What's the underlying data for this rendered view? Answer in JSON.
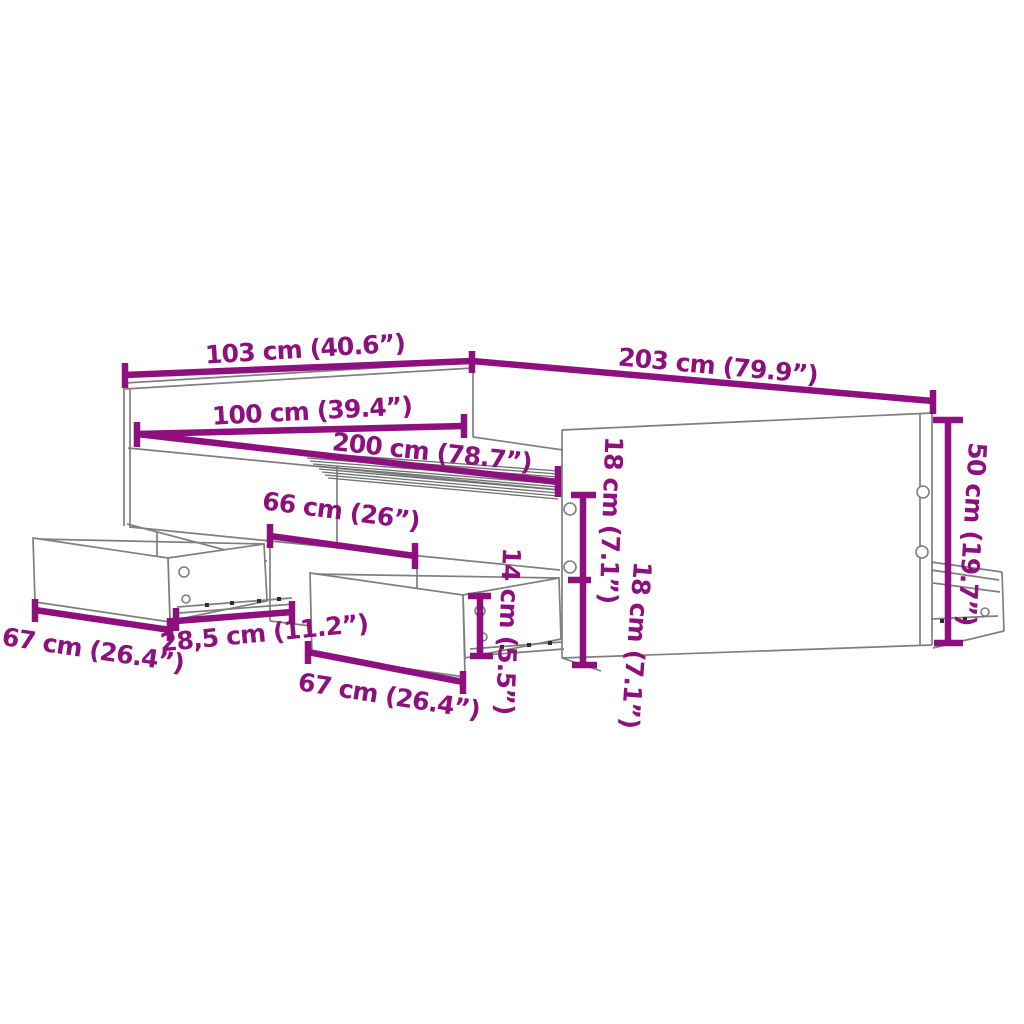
{
  "colors": {
    "dimension": "#8E0F7E",
    "line": "#7f7f7f",
    "slat": "#6f6f6f",
    "background": "#ffffff"
  },
  "labels": {
    "outer_width": "103 cm (40.6”)",
    "outer_length": "203 cm (79.9”)",
    "inner_width": "100 cm (39.4”)",
    "inner_length": "200 cm (78.7”)",
    "drawer_opening_width": "66 cm (26”)",
    "side_panel_height": "50 cm (19.7”)",
    "hole_spacing_upper": "18 cm (7.1”)",
    "hole_spacing_lower": "18 cm (7.1”)",
    "drawer_front_height": "14 cm (5.5”)",
    "left_drawer_width": "67 cm (26.4”)",
    "slide_extension": "28,5 cm (11.2”)",
    "middle_drawer_width": "67 cm (26.4”)"
  }
}
